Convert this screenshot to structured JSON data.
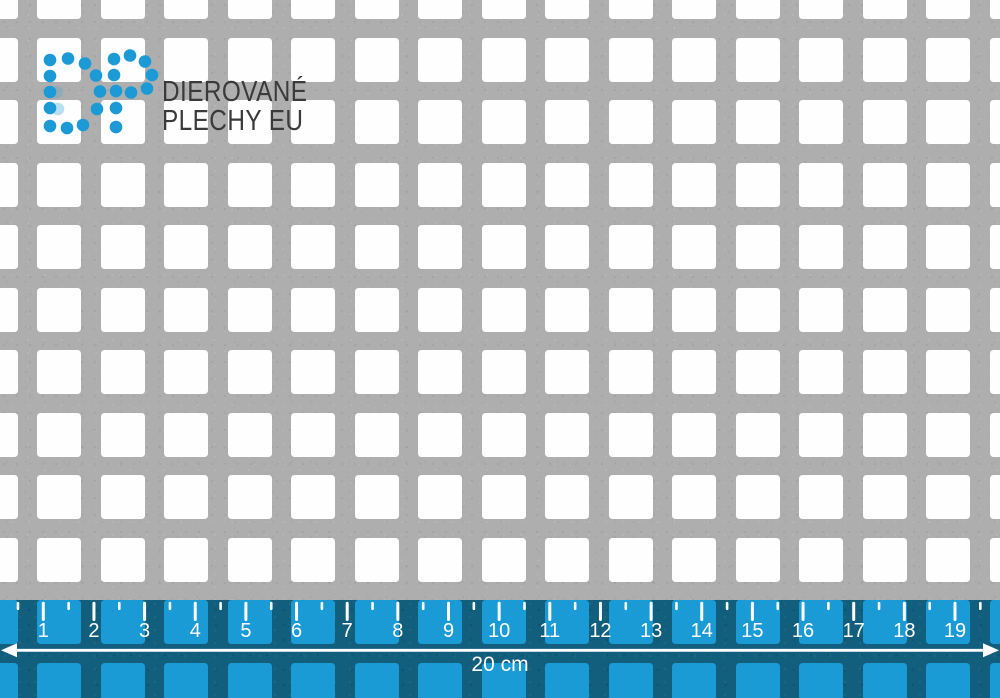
{
  "brand": {
    "letters": "DP",
    "line1": "DIEROVANÉ",
    "line2": "PLECHY EU"
  },
  "ruler": {
    "tick_labels": [
      "1",
      "2",
      "3",
      "4",
      "5",
      "6",
      "7",
      "8",
      "9",
      "10",
      "11",
      "12",
      "13",
      "14",
      "15",
      "16",
      "17",
      "18",
      "19"
    ],
    "length_label": "20 cm"
  },
  "colors": {
    "metal": "#aeaeae",
    "hole": "#fefefe",
    "accent_blue": "#1b9ad6",
    "ruler_bg": "#115e7d",
    "ruler_hole": "#1b9bd5",
    "ink": "#3a3a3a",
    "marks_white": "#ffffff"
  }
}
